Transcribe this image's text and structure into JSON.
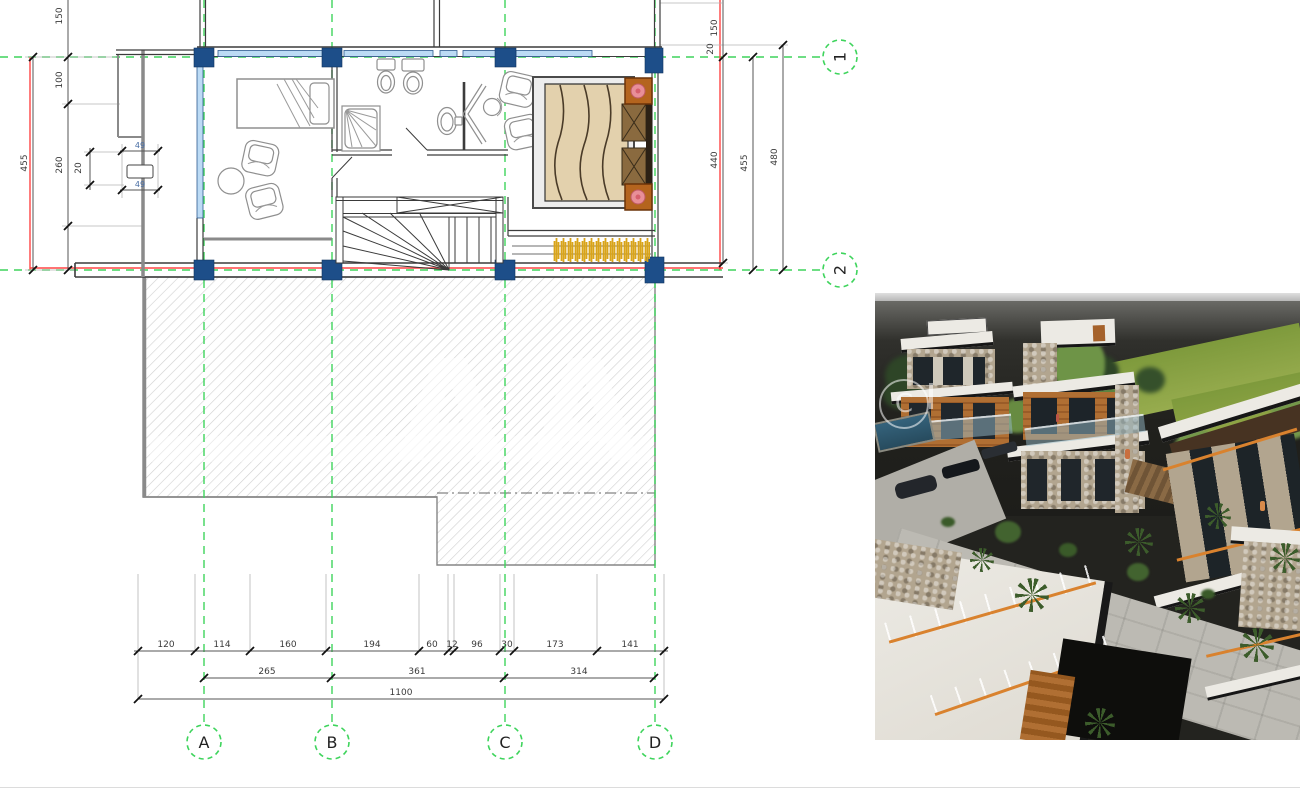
{
  "colors": {
    "green": "#3ed45c",
    "red": "#ff4545",
    "colblue": "#1d4e89",
    "winblue": "#bcdbf5",
    "gold": "#d9a418",
    "wallc": "#3c3c3c",
    "dimc": "#3a3a3a",
    "hatchc": "#d0d0d0",
    "rwhite": "#eceae4",
    "rstone": "#b2a58f",
    "rwood": "#b06f33",
    "rpalm": "#3c5c2b",
    "rgrass": "#8da445",
    "rroad": "#bcbab3",
    "rorange": "#d9822e",
    "rdark": "#23231f"
  },
  "plan": {
    "grid": {
      "columns": [
        "A",
        "B",
        "C",
        "D"
      ],
      "rows": [
        "1",
        "2"
      ]
    },
    "dims": {
      "left": {
        "d150": "150",
        "d100": "100",
        "d260": "260",
        "d455": "455",
        "d20": "20",
        "d49a": "49",
        "d49b": "49"
      },
      "right": {
        "d150": "150",
        "d20": "20",
        "d440": "440",
        "d455": "455",
        "d480": "480"
      },
      "bottom": {
        "chain1": [
          "120",
          "114",
          "160",
          "194",
          "60",
          "12",
          "96",
          "30",
          "173",
          "141"
        ],
        "chain2": [
          "265",
          "361",
          "314"
        ],
        "total": "1100"
      }
    },
    "watermark": [
      "A",
      "A"
    ]
  },
  "render": {
    "watermark": "C"
  }
}
